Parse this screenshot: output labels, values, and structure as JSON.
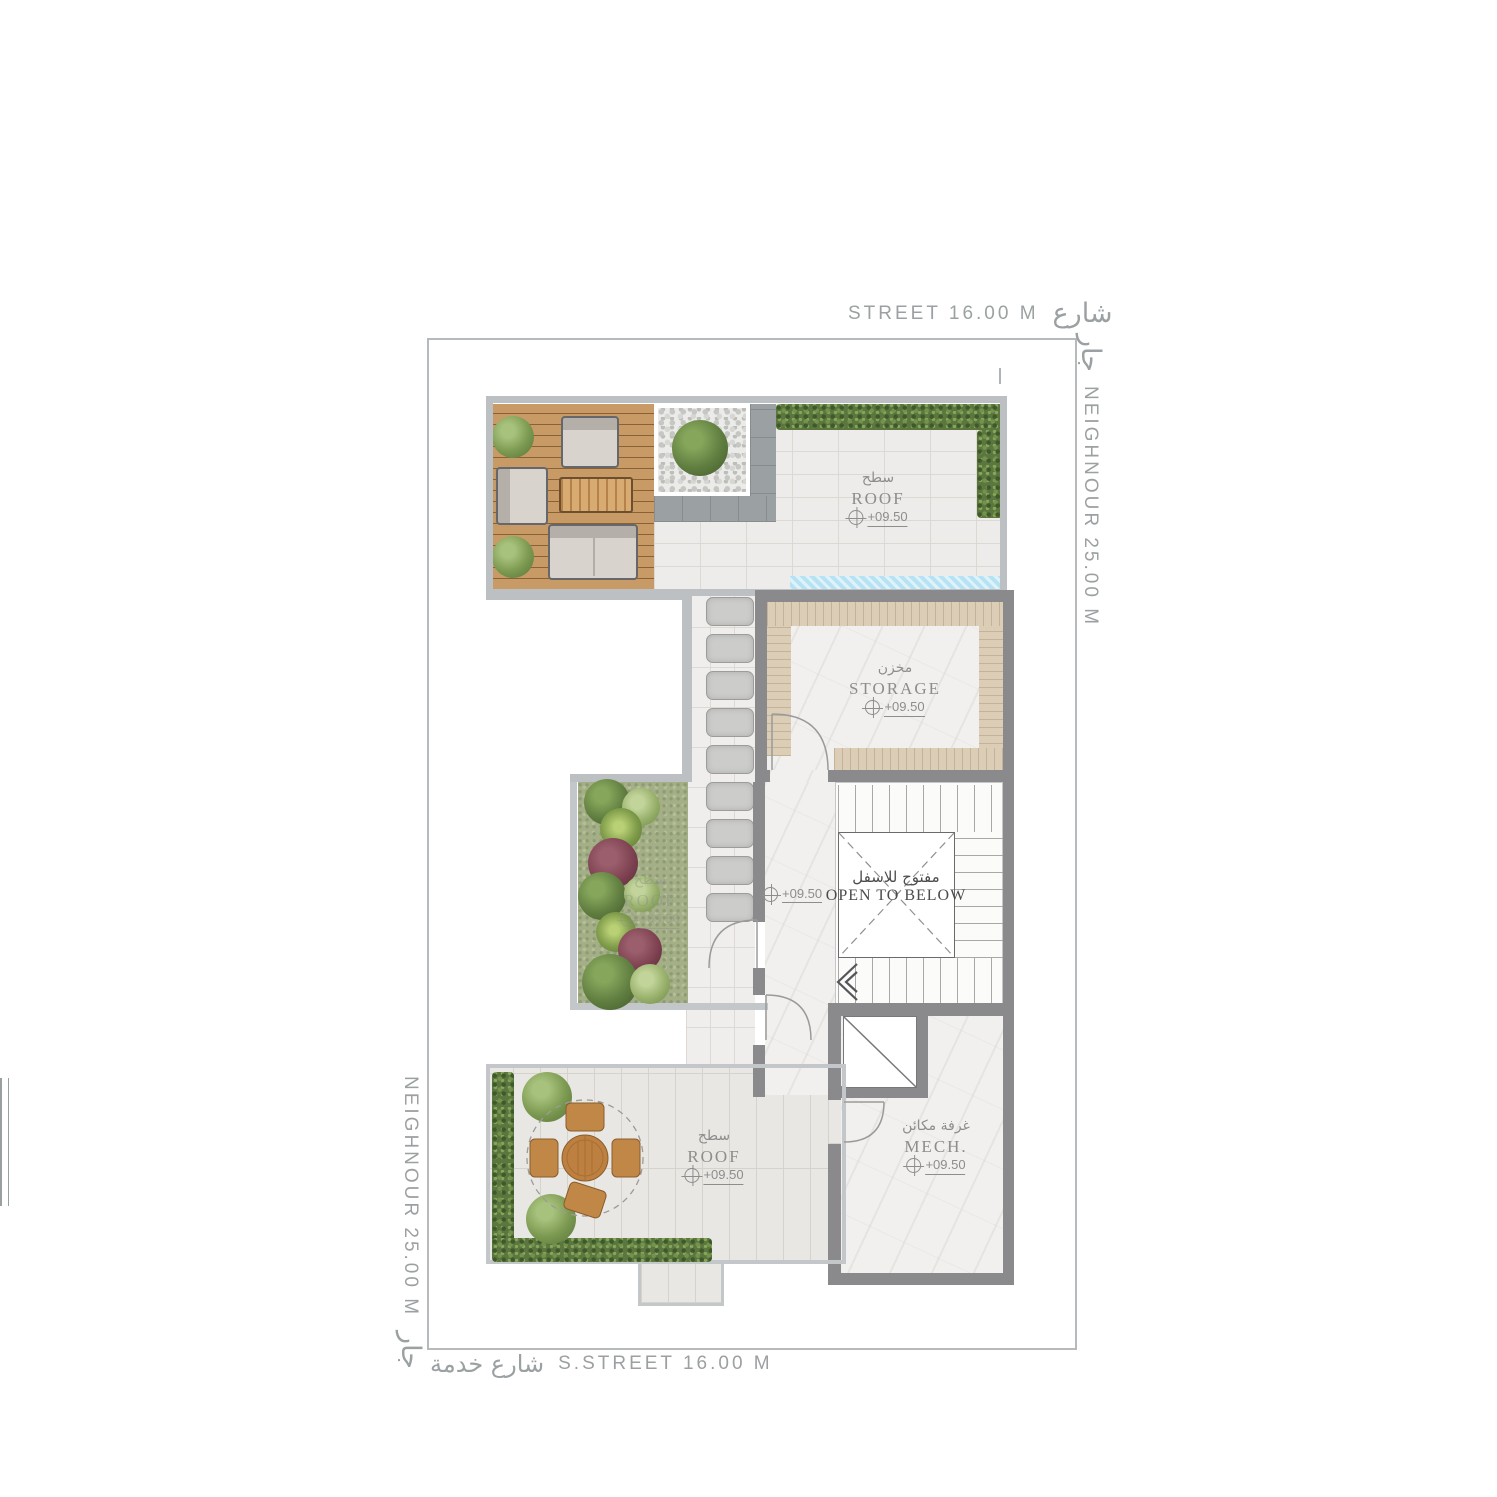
{
  "drawing": {
    "site": {
      "top_street": {
        "en": "STREET 16.00 M",
        "ar": "شارع"
      },
      "right_neighbour": {
        "ar": "جار",
        "en": "NEIGHNOUR 25.00 M"
      },
      "left_neighbour": {
        "en": "NEIGHNOUR 25.00 M",
        "ar": "جار"
      },
      "bottom_street": {
        "ar": "شارع خدمة",
        "en": "S.STREET 16.00 M"
      }
    },
    "rooms": {
      "roof_top": {
        "ar": "سطح",
        "en": "ROOF",
        "level": "+09.50"
      },
      "storage": {
        "ar": "مخزن",
        "en": "STORAGE",
        "level": "+09.50"
      },
      "void": {
        "ar": "مفتوح للاسفل",
        "en": "OPEN TO BELOW"
      },
      "corridor": {
        "level": "+09.50"
      },
      "garden_roof": {
        "ar": "سطح",
        "en": "ROOF",
        "level": "+09.50"
      },
      "mech": {
        "ar": "غرفة مكائن",
        "en": "MECH.",
        "level": "+09.50"
      },
      "roof_terrace": {
        "ar": "سطح",
        "en": "ROOF",
        "level": "+09.50"
      }
    },
    "colors": {
      "wall": "#8a8a8d",
      "boundary": "#bcc0c2",
      "room_label": "#8d8d8d",
      "site_label": "#9ba0a2",
      "deck_wood": "#c79a66",
      "hedge": "#5b763e",
      "grass": "#a4af88",
      "water": "#b7e2f3",
      "marble": "#f1f0ee",
      "paving": "#edecea",
      "void_text": "#4c4c4c"
    }
  }
}
